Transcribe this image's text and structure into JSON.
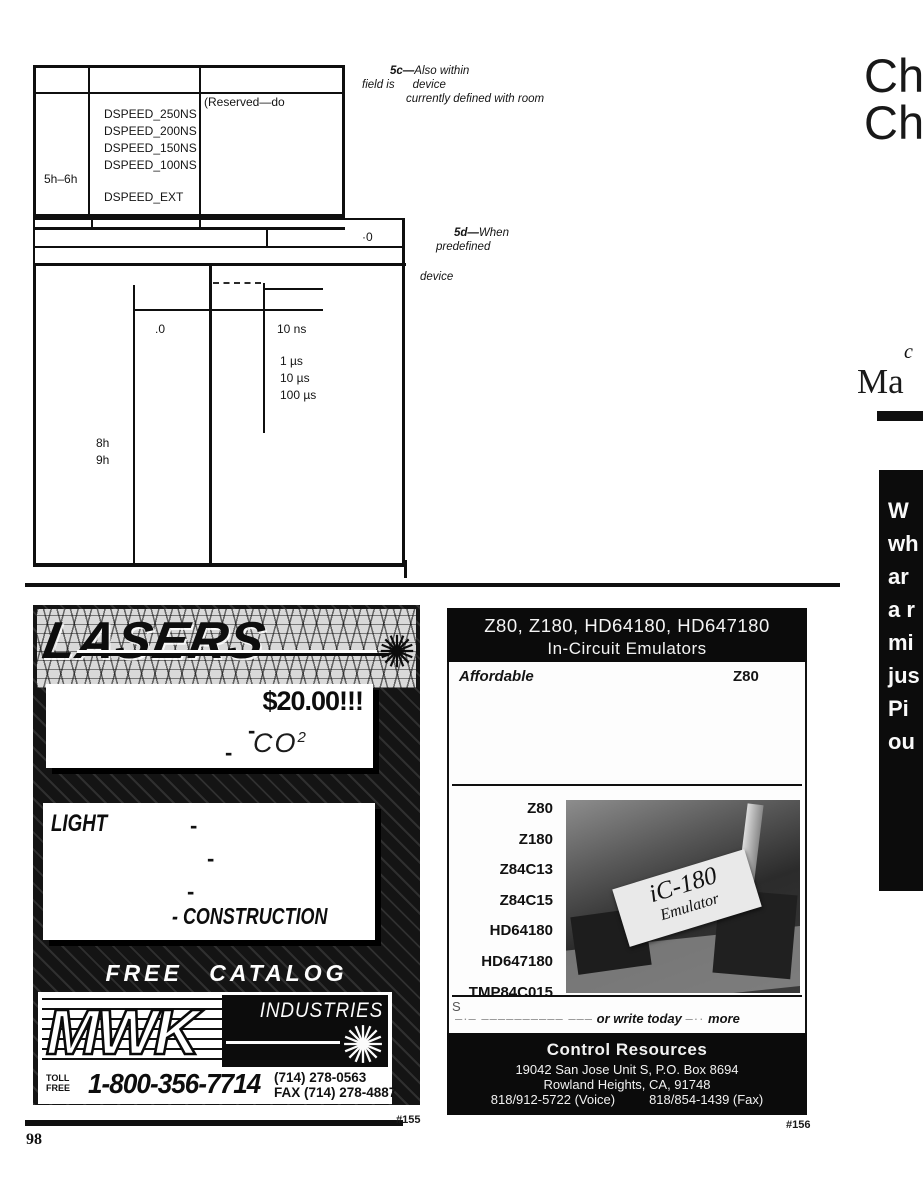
{
  "page": {
    "number": "98"
  },
  "article": {
    "table1": {
      "row_label": "5h–6h",
      "dspeed_values": [
        "DSPEED_250NS",
        "DSPEED_200NS",
        "DSPEED_150NS",
        "DSPEED_100NS"
      ],
      "dspeed_ext": "DSPEED_EXT",
      "reserved_note": "(Reserved—do"
    },
    "caption_5c": {
      "tag": "5c—",
      "line1": "Also within",
      "line2a": "field is",
      "line2b": "device",
      "line3": "currently defined with room"
    },
    "table2_value": "·0",
    "caption_5d": {
      "tag": "5d—",
      "line1": "When",
      "line2": "predefined"
    },
    "caption_device": "device",
    "table3": {
      "dot_zero": ".0",
      "timings": [
        "10 ns",
        "1 µs",
        "10 µs",
        "100 µs"
      ],
      "row_labels": [
        "8h",
        "9h"
      ]
    }
  },
  "right_column": {
    "heading_line1": "Ch",
    "heading_line2": "Ch",
    "fragment_small": "c",
    "fragment_serif": "Ma",
    "panel_lines": [
      "W",
      "wh",
      "ar",
      "a r",
      "mi",
      "jus",
      "Pi",
      "ou"
    ]
  },
  "ads": {
    "lasers": {
      "title": "LASERS",
      "price": "$20.00!!!",
      "dash": "-",
      "co2_main": "CO",
      "co2_sup": "2",
      "light": "LIGHT",
      "construction": "- CONSTRUCTION",
      "free_catalog": "FREE CATALOG",
      "brand": "MWK",
      "brand_suffix": "INDUSTRIES",
      "toll1": "TOLL",
      "toll2": "FREE",
      "phone": "1-800-356-7714",
      "phone2": "(714) 278-0563",
      "fax": "FAX (714) 278-4887",
      "ref": "#155"
    },
    "emulator": {
      "title_line1": "Z80, Z180, HD64180, HD647180",
      "title_line2": "In-Circuit Emulators",
      "affordable": "Affordable",
      "z80_right": "Z80",
      "products": [
        "Z80",
        "Z180",
        "Z84C13",
        "Z84C15",
        "HD64180",
        "HD647180",
        "TMP84C015"
      ],
      "photo_label1": "iC-180",
      "photo_label2": "Emulator",
      "cta_fragment": "S",
      "cta_dashes1": "–·– –––––––––– –––",
      "cta_phrase": "or write today",
      "cta_dashes2": "–··",
      "cta_more": "more",
      "company": "Control Resources",
      "address1": "19042 San Jose Unit S, P.O. Box 8694",
      "address2": "Rowland Heights, CA, 91748",
      "contact_voice": "818/912-5722 (Voice)",
      "contact_fax": "818/854-1439 (Fax)",
      "ref": "#156"
    }
  }
}
